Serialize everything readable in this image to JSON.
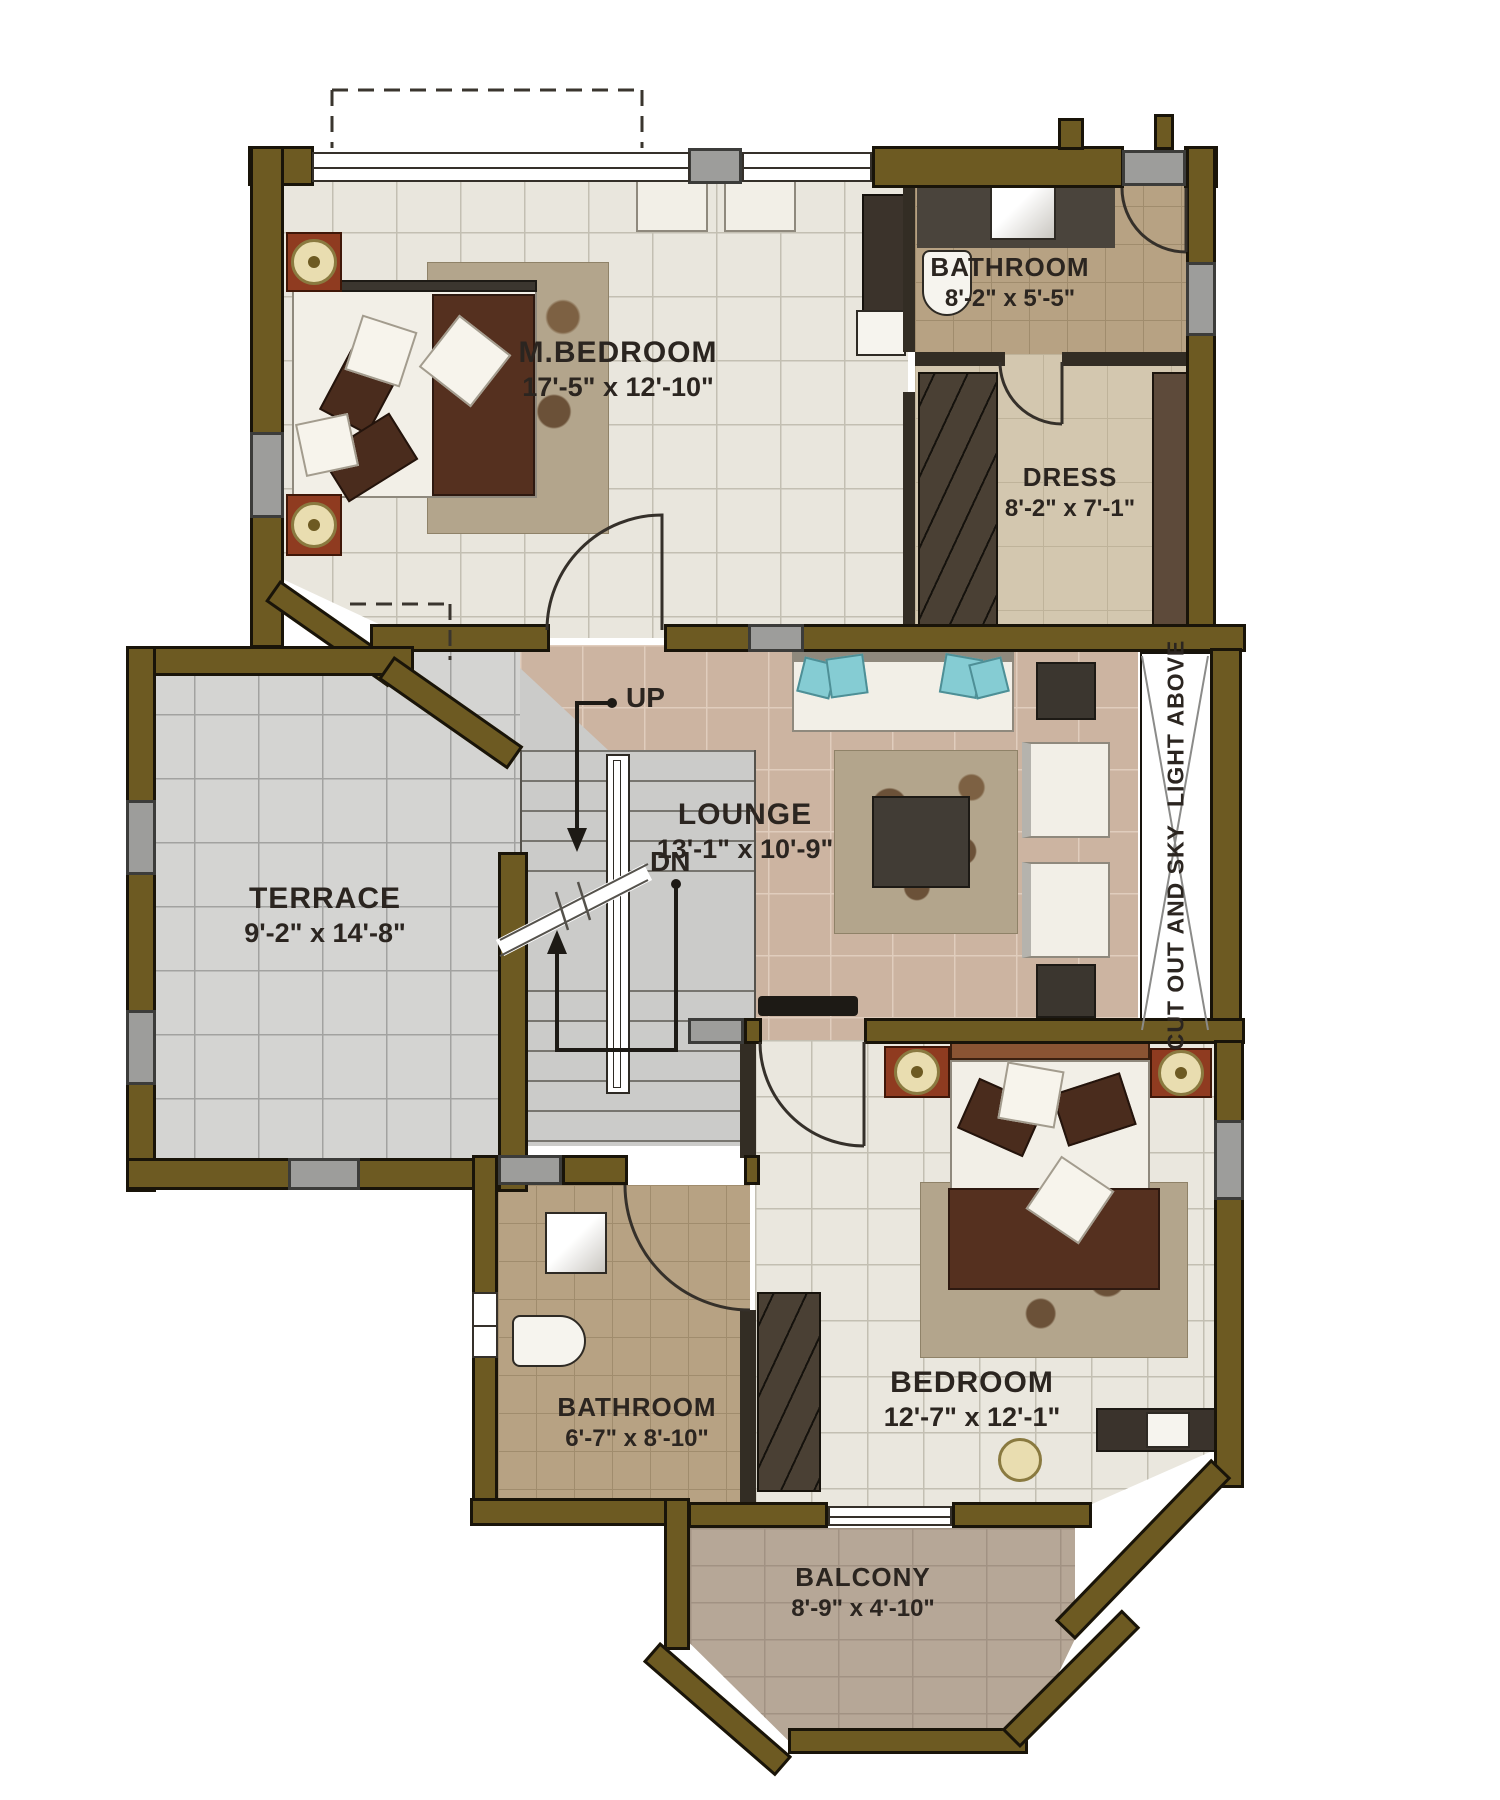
{
  "plan": {
    "rooms": {
      "master_bedroom": {
        "name": "M.BEDROOM",
        "dims": "17'-5\" x 12'-10\""
      },
      "bathroom_top": {
        "name": "BATHROOM",
        "dims": "8'-2\" x 5'-5\""
      },
      "dress": {
        "name": "DRESS",
        "dims": "8'-2\" x 7'-1\""
      },
      "terrace": {
        "name": "TERRACE",
        "dims": "9'-2\" x 14'-8\""
      },
      "lounge": {
        "name": "LOUNGE",
        "dims": "13'-1\" x 10'-9\""
      },
      "bathroom_bottom": {
        "name": "BATHROOM",
        "dims": "6'-7\" x 8'-10\""
      },
      "bedroom": {
        "name": "BEDROOM",
        "dims": "12'-7\" x 12'-1\""
      },
      "balcony": {
        "name": "BALCONY",
        "dims": "8'-9\" x 4'-10\""
      }
    },
    "stairs": {
      "up_label": "UP",
      "down_label": "DN"
    },
    "skylight": {
      "line1": "CUT OUT AND SKY",
      "line2": "LIGHT ABOVE"
    },
    "colors": {
      "wall": "#6d5a22",
      "wall_outline": "#191409",
      "accent_block": "#9d9d9b",
      "master_floor": "#e9e6dd",
      "lounge_floor": "#ccb4a1",
      "terrace_floor": "#d4d4d2",
      "bath_floor": "#b7a283",
      "balcony_floor": "#b6a797",
      "text": "#2b2520",
      "bed_blanket": "#55301f",
      "sofa_pillow": "#85ccd3"
    }
  }
}
